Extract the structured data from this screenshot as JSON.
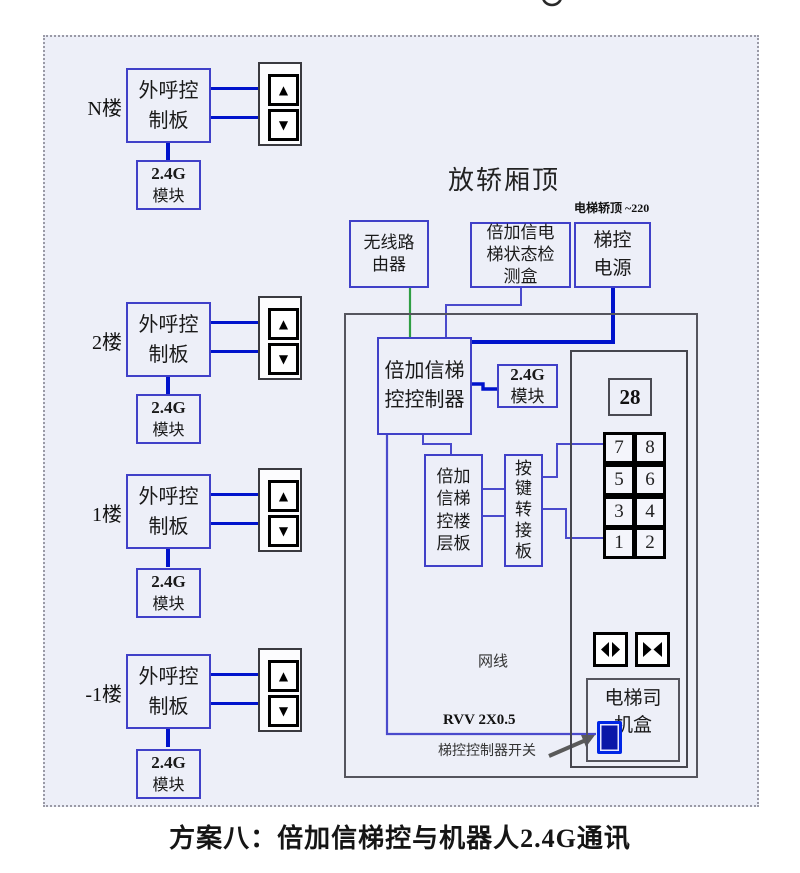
{
  "page": {
    "caption": "方案八：倍加信梯控与机器人2.4G通讯",
    "area_title": "放轿厢顶",
    "power_note": "电梯轿顶 ~220"
  },
  "colors": {
    "accent_blue": "#0013cc",
    "wire_blue_violet": "#4a4acc",
    "wire_green": "#2f9e44",
    "box_border_blue": "#4040c8",
    "box_border_gray": "#55555e",
    "area_bg": "#edeff8"
  },
  "icons": {
    "up_arrow": "▲",
    "down_arrow": "▼"
  },
  "floors": [
    {
      "label": "N楼",
      "board_lines": [
        "外呼控",
        "制板"
      ],
      "module_lines": [
        "2.4G",
        "模块"
      ]
    },
    {
      "label": "2楼",
      "board_lines": [
        "外呼控",
        "制板"
      ],
      "module_lines": [
        "2.4G",
        "模块"
      ]
    },
    {
      "label": "1楼",
      "board_lines": [
        "外呼控",
        "制板"
      ],
      "module_lines": [
        "2.4G",
        "模块"
      ]
    },
    {
      "label": "-1楼",
      "board_lines": [
        "外呼控",
        "制板"
      ],
      "module_lines": [
        "2.4G",
        "模块"
      ]
    }
  ],
  "car_top": {
    "router_lines": [
      "无线路",
      "由器"
    ],
    "detector_lines": [
      "倍加信电",
      "梯状态检",
      "测盒"
    ],
    "power_lines": [
      "梯控",
      "电源"
    ],
    "controller_lines": [
      "倍加信梯",
      "控控制器"
    ],
    "module_lines": [
      "2.4G",
      "模块"
    ],
    "floor_board_lines": [
      "倍加",
      "信梯",
      "控楼",
      "层板"
    ],
    "key_adapter_lines": [
      "按",
      "键",
      "转",
      "接",
      "板"
    ],
    "display_value": "28",
    "buttons": [
      "7",
      "8",
      "5",
      "6",
      "3",
      "4",
      "1",
      "2"
    ],
    "driver_box_lines": [
      "电梯司",
      "机盒"
    ],
    "labels": {
      "network": "网线",
      "rvv": "RVV 2X0.5",
      "switch": "梯控控制器开关"
    }
  }
}
